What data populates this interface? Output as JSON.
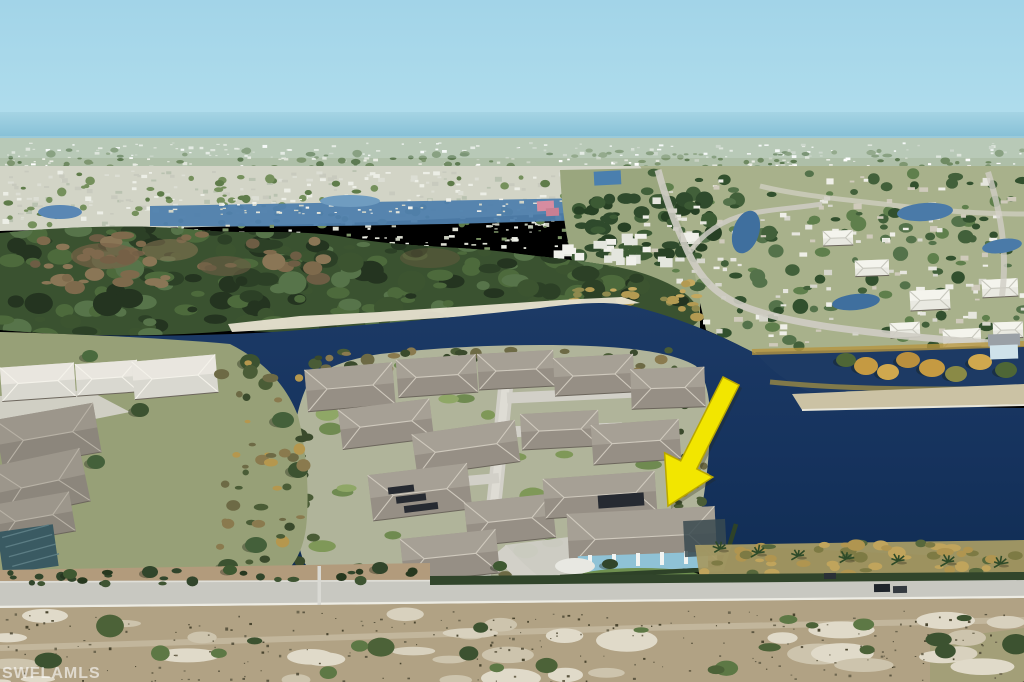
{
  "scene": {
    "type": "aerial real estate photograph",
    "subject": "lakefront residential community with yellow arrow marking a waterfront home"
  },
  "watermark": {
    "text": "SWFLAMLS",
    "color": "#ffffff"
  },
  "arrow": {
    "fill": "#f2e600",
    "outline": "#b8a600",
    "tail_x": 731,
    "tail_y": 381,
    "tip_x": 668,
    "tip_y": 506
  },
  "colors": {
    "sky_top": "#a2d4e8",
    "sky_horizon": "#bfe3ef",
    "sea": "#85c1d8",
    "distant_land": "#aebfa8",
    "suburb_base": "#d2d4c6",
    "canal_water": "#4f7fad",
    "community_ground": "#a8b18b",
    "community_finger": "#9aa67e",
    "forest_base": "#3a5230",
    "sand": "#e7e1d0",
    "lake": "#16335e",
    "peninsula_ground": "#b0b49a",
    "left_ground": "#97a077",
    "street": "#d2d0c8",
    "roof": "#968f85",
    "roof_light": "#aaa499",
    "white_roof": "#e9e9e1",
    "wall_teal": "#8fc2d6",
    "solar_panel": "#262a31",
    "shore_gold": "#a59a64",
    "berm": "#cbc2a4",
    "road": "#c8c8c1",
    "curb": "#edece4",
    "hedge": "#31452b",
    "dirt": "#b29b7c",
    "scrub": "#b1a284",
    "scrub_sand": "#d6cfbb",
    "bush": "#4e6339",
    "pole": "#d9d9d3",
    "pond": "#3f6f9e",
    "pink_building": "#d78ca0",
    "blue_building": "#4a7fae",
    "lanai_screen": "#3a4a50"
  }
}
